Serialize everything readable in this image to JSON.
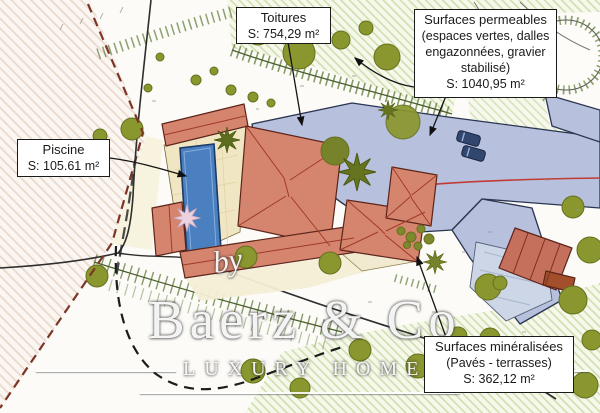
{
  "plan": {
    "labels": {
      "toitures": {
        "title": "Toitures",
        "area": "S: 754,29 m²"
      },
      "surfaces_permeables": {
        "title": "Surfaces permeables",
        "detail1": "(espaces vertes, dalles",
        "detail2": "engazonnées, gravier",
        "detail3": "stabilisé)",
        "area": "S: 1040,95 m²"
      },
      "piscine": {
        "title": "Piscine",
        "area": "S: 105.61 m²"
      },
      "surfaces_mineralisees": {
        "title": "Surfaces minéralisées",
        "detail": "(Pavés - terrasses)",
        "area": "S: 362,12 m²"
      }
    },
    "colors": {
      "roof": "#d5846e",
      "roof_dark": "#c4705c",
      "roof_edge": "#8a3524",
      "pool": "#4a7fc0",
      "deck": "#f0e6c4",
      "permeable_blue": "#b7c1dd",
      "paved_blue": "#ccd6e7",
      "tree_green": "#8a962e",
      "slope_green": "#5d7a38",
      "boundary_red": "#7c3526",
      "road_centerline": "#c23b35"
    }
  },
  "watermark": {
    "prefix": "by",
    "brand": "Baerz & Co",
    "tagline": "LUXURY HOMES"
  }
}
